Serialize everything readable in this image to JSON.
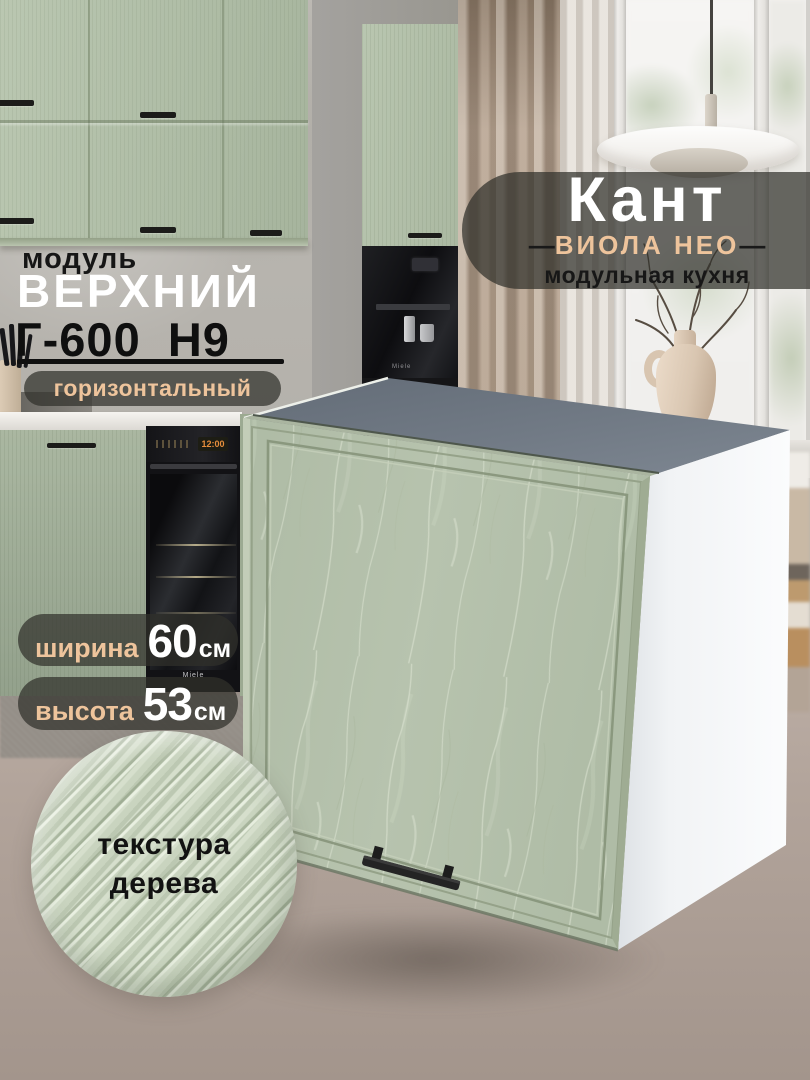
{
  "brand": {
    "title": "Кант",
    "series": "ВИОЛА НЕО",
    "dash": "—",
    "subtitle": "модульная кухня"
  },
  "module": {
    "label": "модуль",
    "type": "ВЕРХНИЙ",
    "code": "Г-600_Н9",
    "orientation": "горизонтальный"
  },
  "dimensions": {
    "width": {
      "label": "ширина",
      "value": "60",
      "unit": "см"
    },
    "height": {
      "label": "высота",
      "value": "53",
      "unit": "см"
    }
  },
  "texture": {
    "line1": "текстура",
    "line2": "дерева"
  },
  "background_details": {
    "appliance_brand": "Miele",
    "oven_clock": "12:00"
  },
  "colors": {
    "accent_peach": "#eec49c",
    "facade_sage": "#b5c1ab",
    "cabinet_top_gray": "#6e7781",
    "carcass_white": "#f2f4f6",
    "badge_overlay": "rgba(49,49,43,0.72)",
    "text_dark": "#161616",
    "text_white": "#ffffff"
  }
}
